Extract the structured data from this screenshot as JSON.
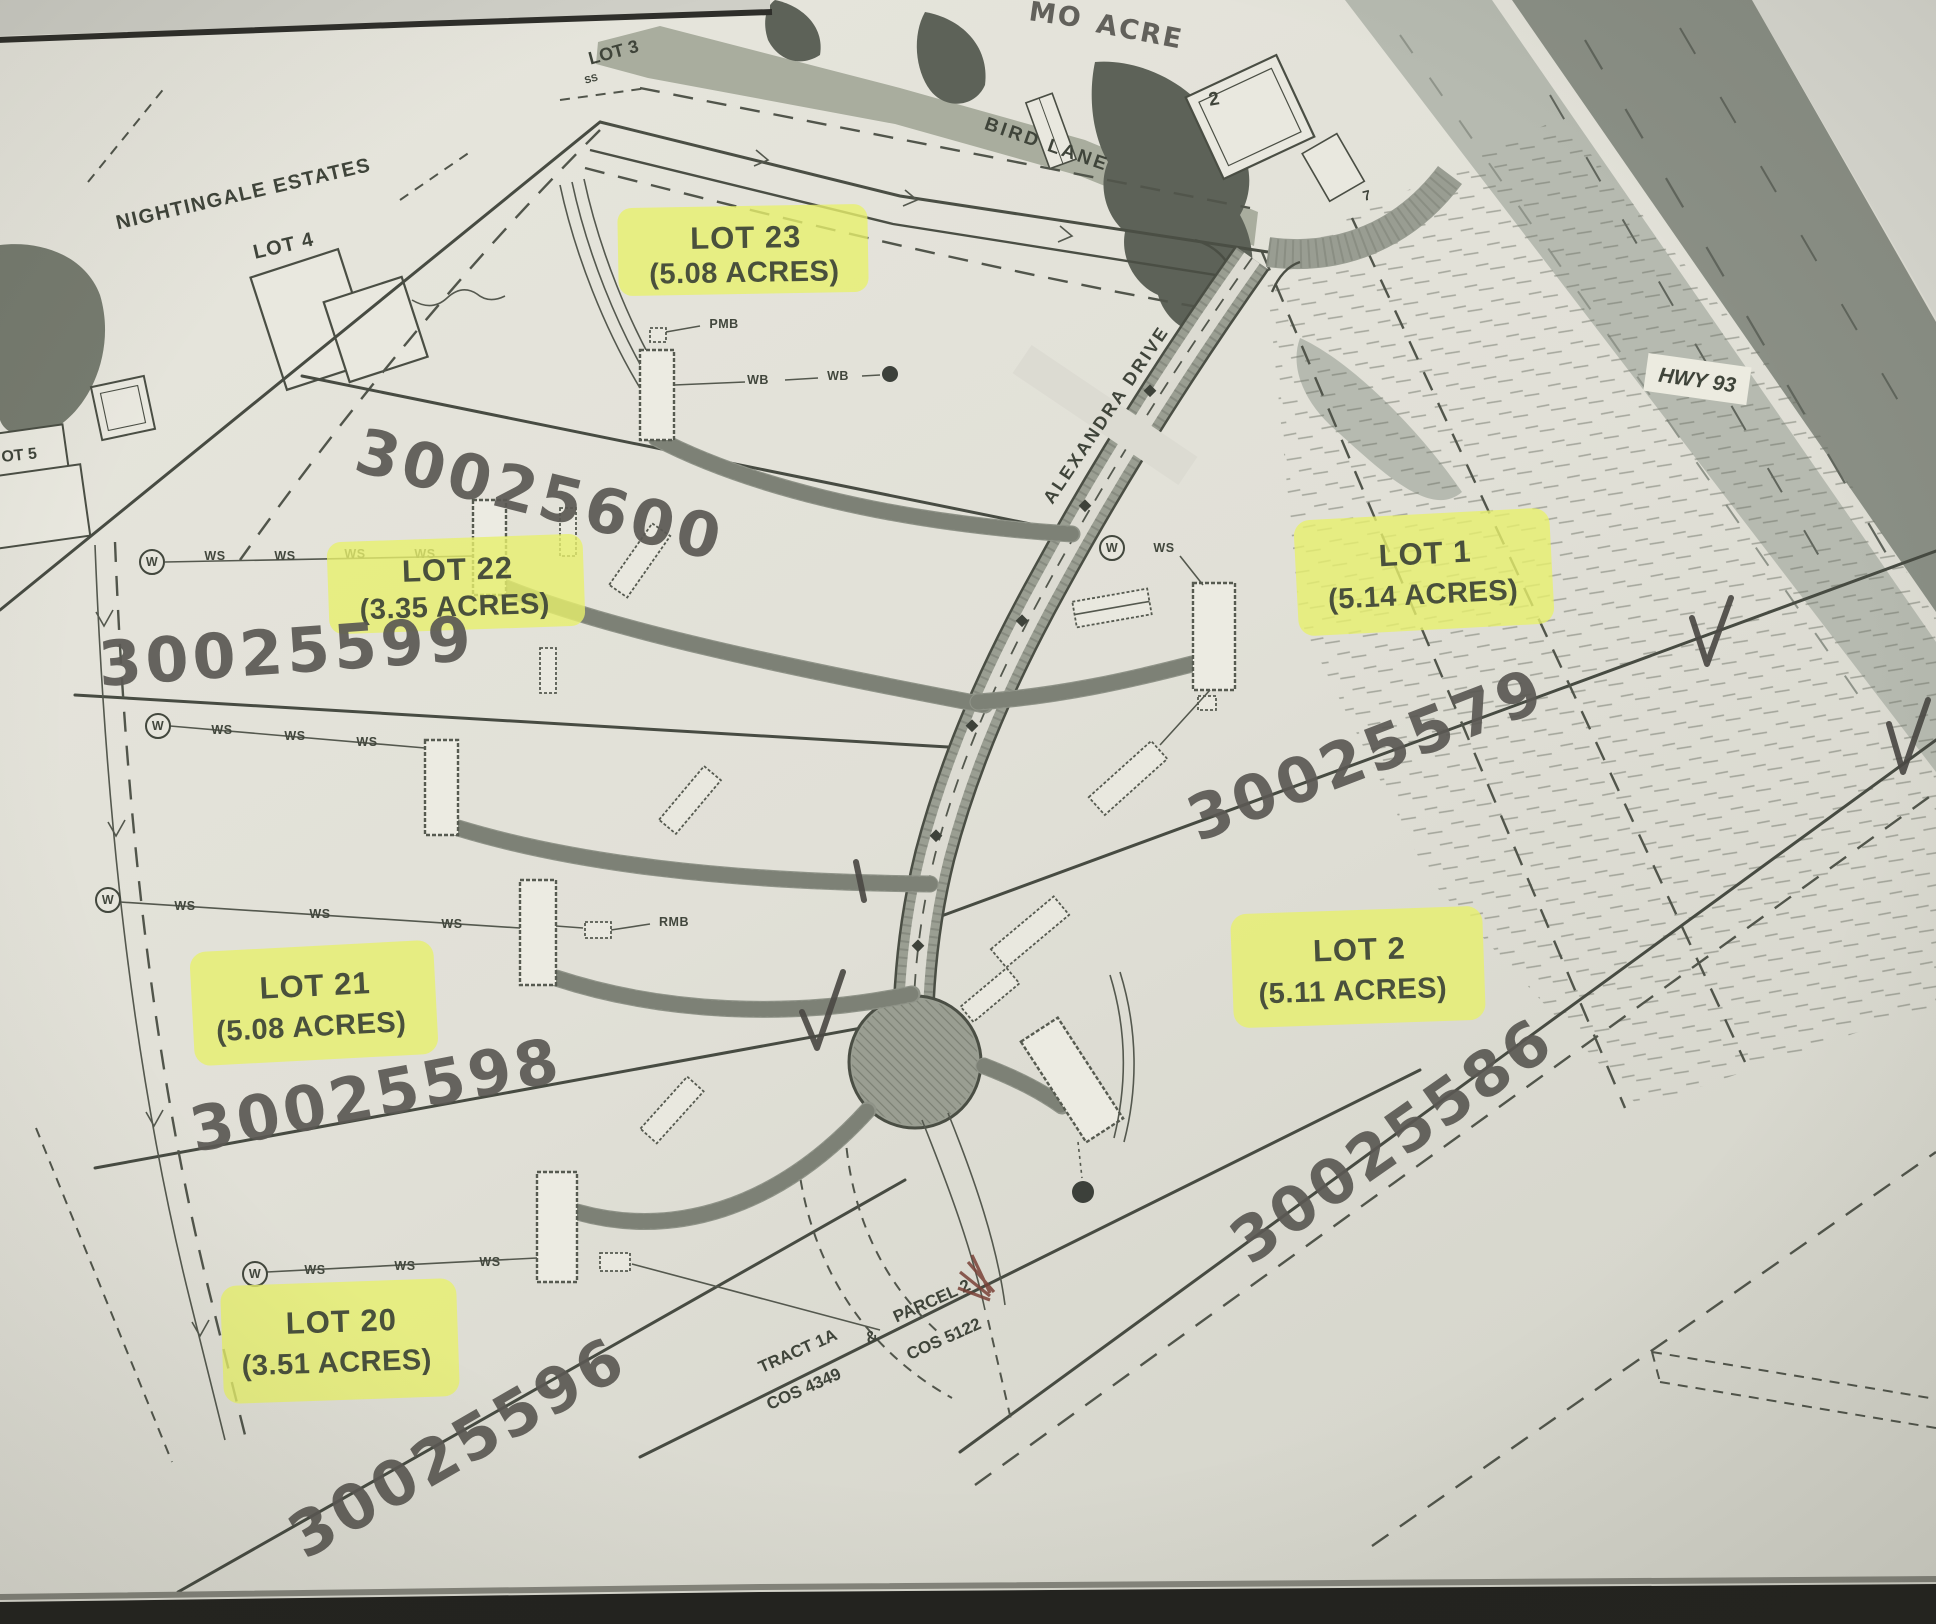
{
  "map": {
    "offsite": {
      "neighborhood": "NIGHTINGALE ESTATES",
      "neighborhood_lot": "LOT 4",
      "lot3": "LOT 3",
      "lot3_note": "SS",
      "lot5_partial": "OT 5",
      "adjacent_lot_2": "2",
      "adjacent_lot_7": "7",
      "top_partial_word_1": "MO",
      "top_partial_word_2": "ACRE"
    },
    "roads": {
      "bird_lane": "BIRD LANE",
      "alexandra_drive": "ALEXANDRA DRIVE",
      "hwy": "HWY 93"
    },
    "lots": [
      {
        "name": "LOT 23",
        "acres": "(5.08 ACRES)",
        "parcel_number": "30025600"
      },
      {
        "name": "LOT 22",
        "acres": "(3.35 ACRES)",
        "parcel_number": "30025599"
      },
      {
        "name": "LOT 21",
        "acres": "(5.08 ACRES)",
        "parcel_number": "30025598"
      },
      {
        "name": "LOT 20",
        "acres": "(3.51 ACRES)",
        "parcel_number": "30025596"
      },
      {
        "name": "LOT 1",
        "acres": "(5.14 ACRES)",
        "parcel_number": "30025579"
      },
      {
        "name": "LOT 2",
        "acres": "(5.11 ACRES)",
        "parcel_number": "30025586"
      }
    ],
    "tract_note": {
      "tract": "TRACT 1A",
      "tract_cos": "COS 4349",
      "ampersand": "&",
      "parcel": "PARCEL 2",
      "parcel_cos": "COS 5122"
    },
    "utility_labels": {
      "ws": "WS",
      "wb": "WB",
      "pmb": "PMB",
      "rmb": "RMB",
      "w": "W"
    },
    "colors": {
      "highlight": "#e7f06d",
      "map_ink": "#474b42",
      "marker_ink": "#5b5954",
      "paper": "#e2e1d8",
      "hwy_dark": "#8a8f85",
      "hwy_light": "#b6bab0",
      "road_fill": "#9a9e92"
    }
  }
}
